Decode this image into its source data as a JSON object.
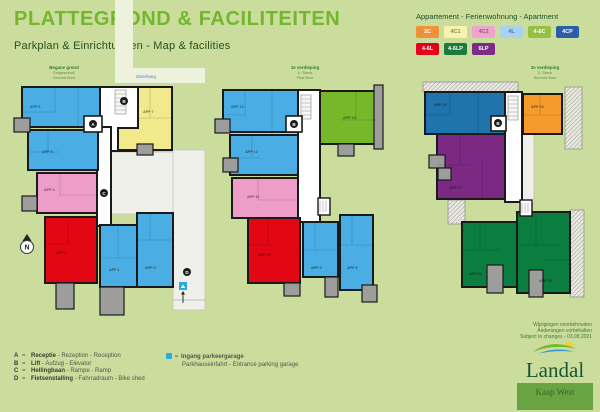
{
  "header": {
    "title": "PLATTEGROND & FACILITEITEN",
    "subtitle": "Parkplan & Einrichtungen  - Map & facilities"
  },
  "legend": {
    "title": "Appartement - Ferienwohnung - Apartment",
    "items": [
      {
        "label": "2C",
        "bg": "#f0913a",
        "fg": "#ffffff"
      },
      {
        "label": "4C1",
        "bg": "#f8f3ae",
        "fg": "#8a8a55"
      },
      {
        "label": "4C2",
        "bg": "#f0a3cd",
        "fg": "#9c5b7e"
      },
      {
        "label": "4L",
        "bg": "#a9d2f0",
        "fg": "#4a7aa8"
      },
      {
        "label": "4-6C",
        "bg": "#97bf45",
        "fg": "#ffffff"
      },
      {
        "label": "4CP",
        "bg": "#2d5ca8",
        "fg": "#ffffff"
      },
      {
        "label": "4-6L",
        "bg": "#e2001a",
        "fg": "#ffffff"
      },
      {
        "label": "4-6LP",
        "bg": "#1c7a3a",
        "fg": "#ffffff"
      },
      {
        "label": "6LP",
        "bg": "#7d2b87",
        "fg": "#ffffff"
      }
    ]
  },
  "plans": {
    "ground": {
      "lines": [
        "Begane grond",
        "Erdgeschoß",
        "Ground floor"
      ]
    },
    "first": {
      "lines": [
        "1e verdieping",
        "1. Stock",
        "First floor"
      ]
    },
    "second": {
      "lines": [
        "2e verdieping",
        "2. Stock",
        "Second floor"
      ]
    }
  },
  "map": {
    "road_label": "Zwerfweg",
    "compass": "N",
    "apartments": {
      "app1": "APP 1",
      "app2": "APP 2",
      "app3": "APP 3",
      "app4": "APP 4",
      "app5": "APP 5",
      "app6": "APP 6",
      "app7": "APP 7",
      "app8": "APP 8",
      "app9": "APP 9",
      "app10": "APP 10",
      "app11": "APP 11",
      "app12": "APP 12",
      "app13": "APP 13",
      "app14": "APP 14",
      "app15": "APP 15",
      "app16": "APP 16",
      "app17": "APP 17",
      "app19": "APP 19",
      "app20": "APP 20"
    }
  },
  "palette": {
    "blue": "#4aaee4",
    "yellow": "#f2e98c",
    "pink": "#ee9cc8",
    "red": "#e30613",
    "green": "#76b82a",
    "dark_blue": "#1f74ad",
    "orange": "#f59b2d",
    "purple": "#7b2982",
    "dark_green": "#0b7d3e",
    "parking_blue": "#29abe2"
  },
  "facilities": {
    "eq": "=",
    "items": [
      {
        "letter": "A",
        "name": "Receptie",
        "translations": "- Rezeption - Reception"
      },
      {
        "letter": "B",
        "name": "Lift",
        "translations": "- Aufzug - Elevator"
      },
      {
        "letter": "C",
        "name": "Hellingbaan",
        "translations": "- Rampe - Ramp"
      },
      {
        "letter": "D",
        "name": "Fietsenstalling",
        "translations": "- Fahrradraum - Bike shed"
      }
    ]
  },
  "parking": {
    "name": "Ingang parkeergarage",
    "translations": "Parkhauseinfahrt - Entrance parking garage"
  },
  "note": {
    "lines": [
      "Wijzigingen voorbehouden",
      "Änderungen vorbehalten",
      "Subject to changes - 03.08.2021"
    ]
  },
  "logo": {
    "brand": "Landal",
    "park": "Kaap West"
  }
}
